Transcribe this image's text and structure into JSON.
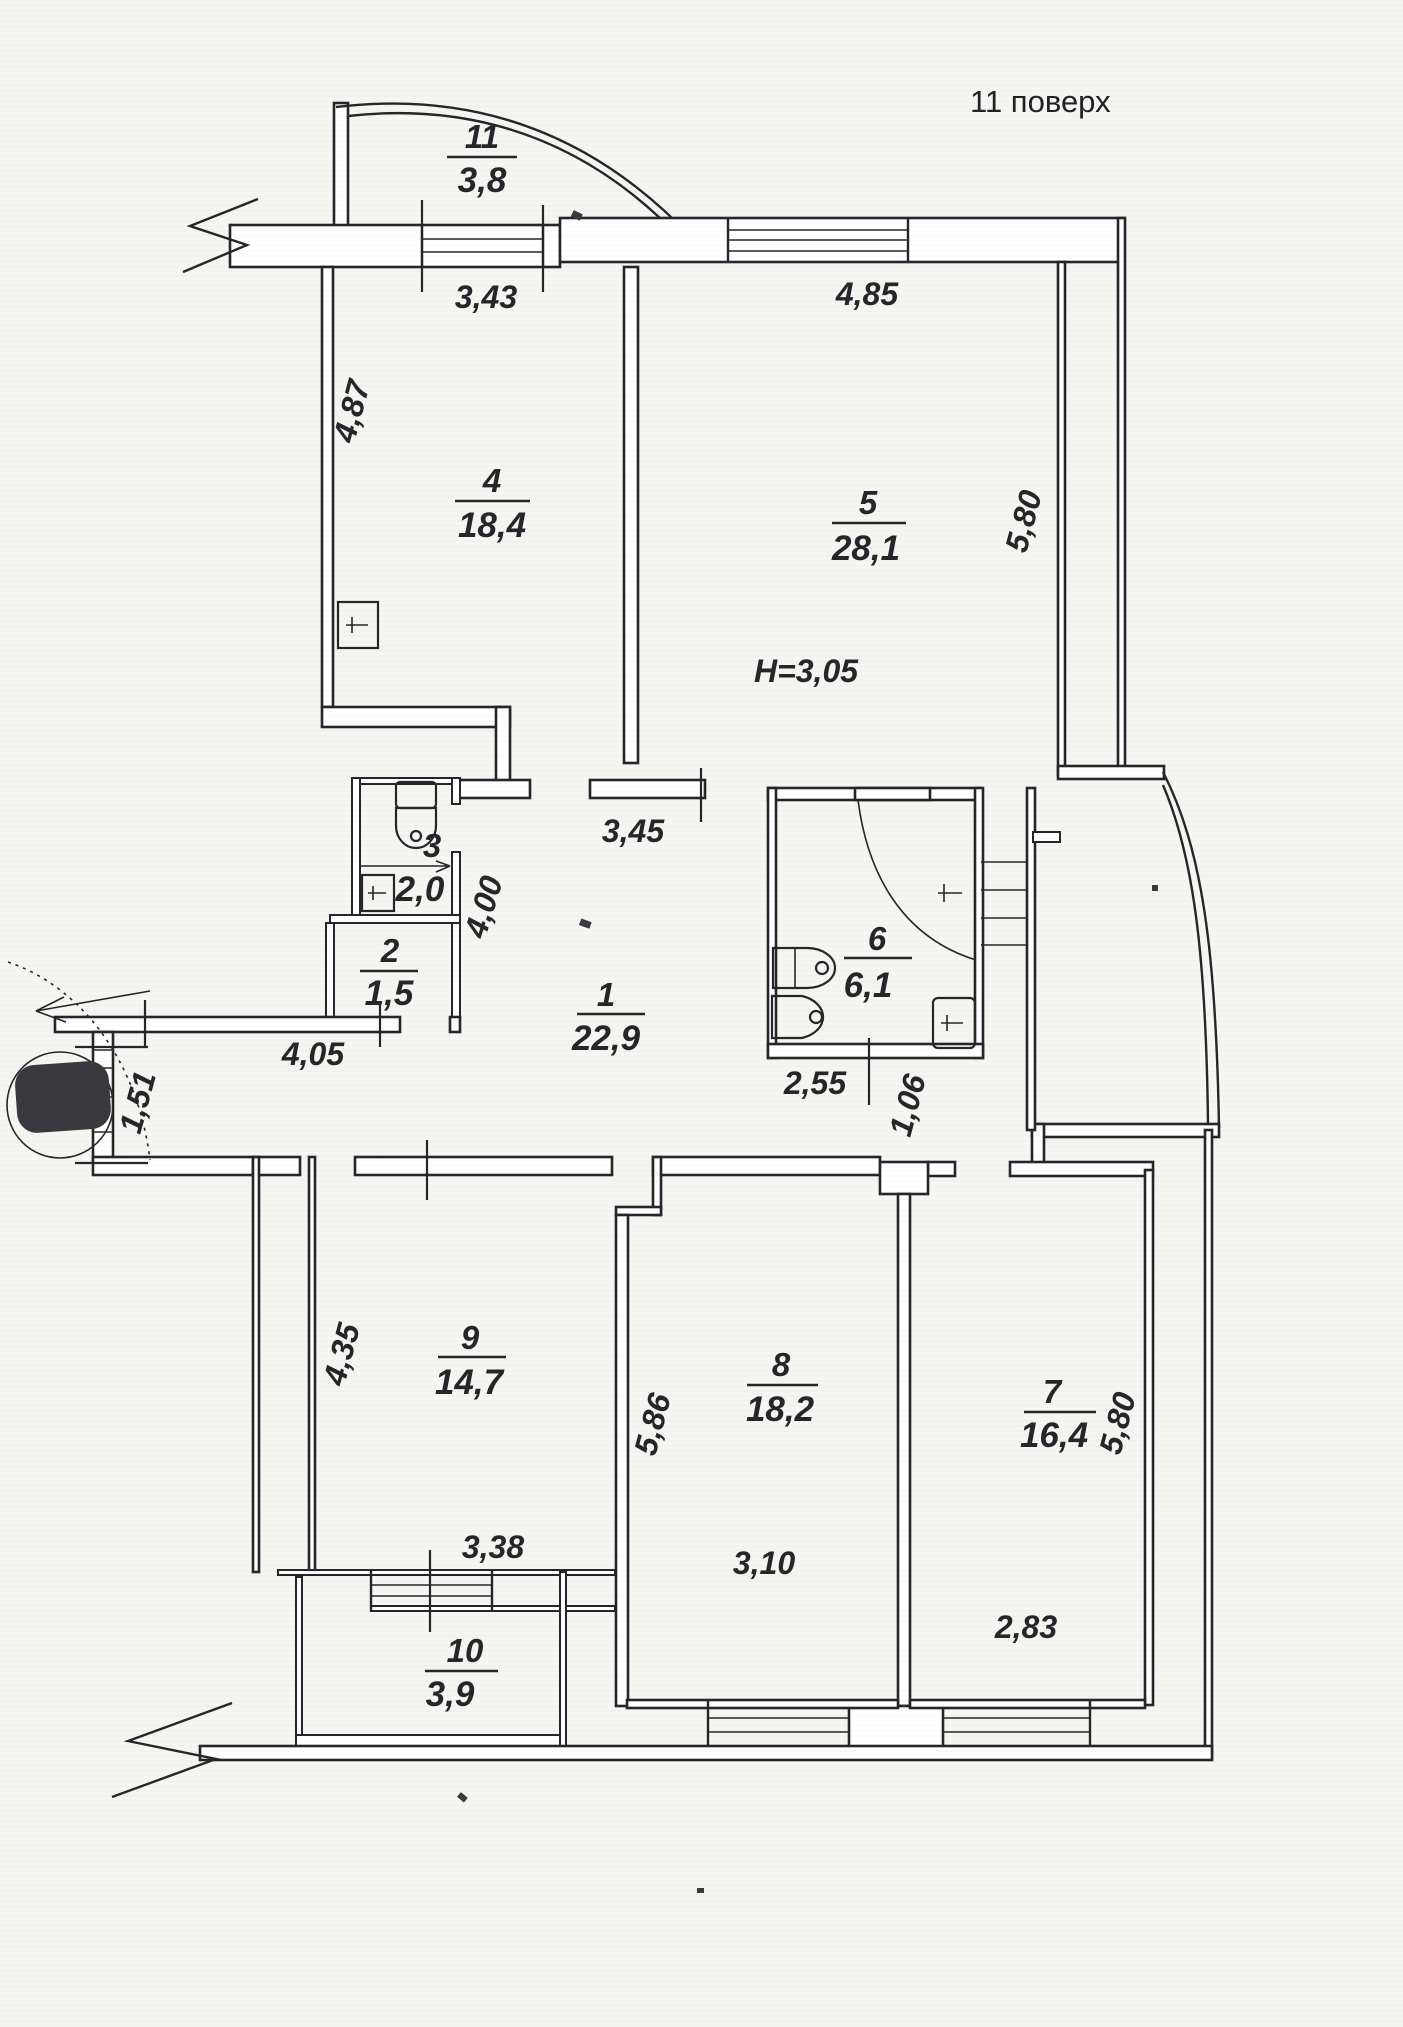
{
  "title": "11 поверх",
  "rooms": {
    "r1": {
      "number": "1",
      "area": "22,9"
    },
    "r2": {
      "number": "2",
      "area": "1,5"
    },
    "r3": {
      "number": "3",
      "area": "2,0"
    },
    "r4": {
      "number": "4",
      "area": "18,4"
    },
    "r5": {
      "number": "5",
      "area": "28,1"
    },
    "r6": {
      "number": "6",
      "area": "6,1"
    },
    "r7": {
      "number": "7",
      "area": "16,4"
    },
    "r8": {
      "number": "8",
      "area": "18,2"
    },
    "r9": {
      "number": "9",
      "area": "14,7"
    },
    "r10": {
      "number": "10",
      "area": "3,9"
    },
    "r11": {
      "number": "11",
      "area": "3,8"
    }
  },
  "dimensions": {
    "room4_width": "3,43",
    "room4_depth": "4,87",
    "room5_width": "4,85",
    "room5_depth": "5,80",
    "hall_top": "3,45",
    "hall_depth": "4,00",
    "corridor": "4,05",
    "entry": "1,51",
    "room6_width": "2,55",
    "shaft": "1,06",
    "room9_depth": "4,35",
    "room9_width": "3,38",
    "room8_depth": "5,86",
    "room8_width": "3,10",
    "room7_depth": "5,80",
    "room7_width": "2,83"
  },
  "notes": {
    "ceiling_height": "H=3,05"
  },
  "colors": {
    "ink": "#26262a",
    "paper": "#f5f5f2"
  }
}
